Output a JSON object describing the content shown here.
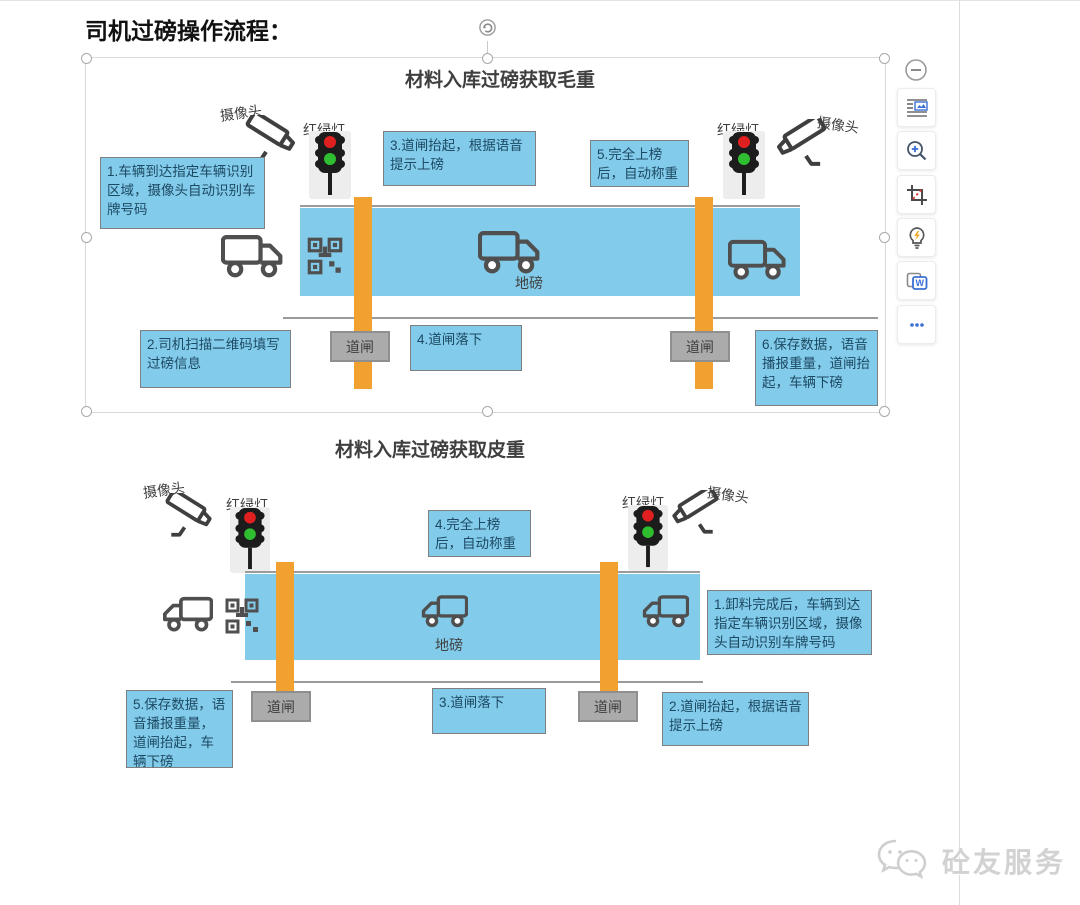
{
  "page_title": "司机过磅操作流程：",
  "colors": {
    "step_box_blue": "#82CBEA",
    "barrier_orange": "#F1A12F",
    "gate_gray": "#ABABAB",
    "red_light": "#E02020",
    "green_light": "#2FBE2F"
  },
  "diagram1": {
    "title": "材料入库过磅获取毛重",
    "camera_left": "摄像头",
    "traffic_left": "红绿灯",
    "traffic_right": "红绿灯",
    "camera_right": "摄像头",
    "scale_label": "地磅",
    "barrier_left": "道闸",
    "barrier_right": "道闸",
    "step1": "1.车辆到达指定车辆识别区域，摄像头自动识别车牌号码",
    "step2": "2.司机扫描二维码填写过磅信息",
    "step3": "3.道闸抬起，根据语音提示上磅",
    "step4": "4.道闸落下",
    "step5": "5.完全上榜后，自动称重",
    "step6": "6.保存数据，语音播报重量，道闸抬起，车辆下磅"
  },
  "diagram2": {
    "title": "材料入库过磅获取皮重",
    "camera_left": "摄像头",
    "traffic_left": "红绿灯",
    "traffic_right": "红绿灯",
    "camera_right": "摄像头",
    "scale_label": "地磅",
    "barrier_left": "道闸",
    "barrier_right": "道闸",
    "step1": "1.卸料完成后，车辆到达指定车辆识别区域，摄像头自动识别车牌号码",
    "step2": "2.道闸抬起，根据语音提示上磅",
    "step3": "3.道闸落下",
    "step4": "4.完全上榜后，自动称重",
    "step5": "5.保存数据，语音播报重量，道闸抬起，车辆下磅"
  },
  "toolbar": {
    "icons": [
      "collapse-minus",
      "text-wrap",
      "zoom-in",
      "crop",
      "smart-tips",
      "extract-doc",
      "more-dots"
    ],
    "extract_letter": "W"
  },
  "footer_logo": "砼友服务"
}
